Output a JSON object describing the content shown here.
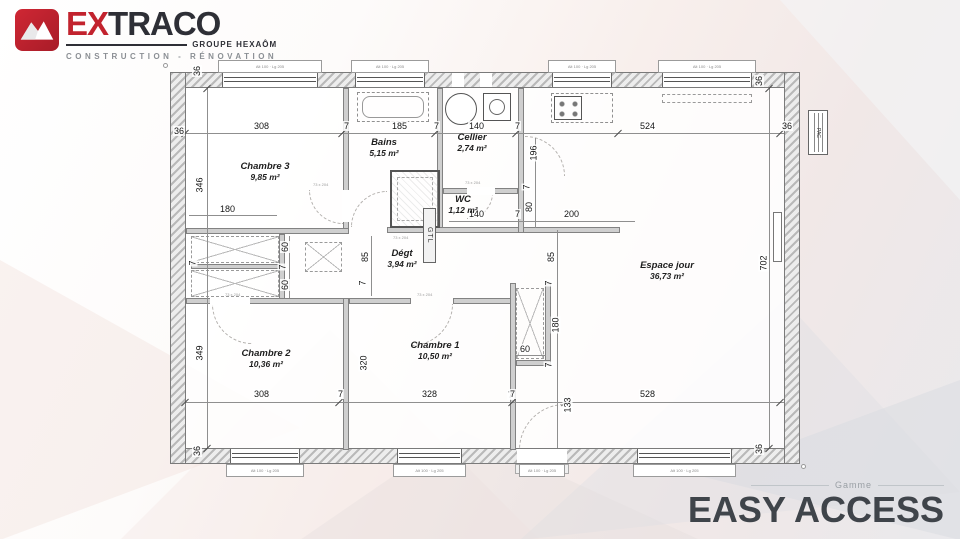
{
  "brand": {
    "name_red": "EX",
    "name_dark": "TRACO",
    "group": "GROUPE HEXAÔM",
    "tagline": "CONSTRUCTION - RÉNOVATION",
    "colors": {
      "red": "#c2232e",
      "dark": "#2e2f36"
    }
  },
  "collection": {
    "label": "Gamme",
    "name": "EASY ACCESS",
    "color": "#3f444a"
  },
  "plan": {
    "rooms": [
      {
        "name": "Chambre 3",
        "area": "9,85 m²"
      },
      {
        "name": "Bains",
        "area": "5,15 m²"
      },
      {
        "name": "Cellier",
        "area": "2,74 m²"
      },
      {
        "name": "WC",
        "area": "1,12 m²"
      },
      {
        "name": "Dégt",
        "area": "3,94 m²"
      },
      {
        "name": "Espace jour",
        "area": "36,73 m²"
      },
      {
        "name": "Chambre 2",
        "area": "10,36 m²"
      },
      {
        "name": "Chambre 1",
        "area": "10,50 m²"
      }
    ],
    "annotations": {
      "gtl": "GTL",
      "pac": "PAC",
      "window_tag": "Alt 100 · Lg 205",
      "door_tag": "73 x 204"
    },
    "dims": [
      "36",
      "36",
      "308",
      "7",
      "185",
      "7",
      "140",
      "7",
      "524",
      "36",
      "36",
      "196",
      "346",
      "180",
      "7",
      "60",
      "7",
      "60",
      "85",
      "7",
      "85",
      "7",
      "80",
      "7",
      "140",
      "7",
      "200",
      "180",
      "60",
      "7",
      "133",
      "7",
      "349",
      "320",
      "308",
      "7",
      "328",
      "7",
      "528",
      "36",
      "36",
      "702"
    ]
  }
}
